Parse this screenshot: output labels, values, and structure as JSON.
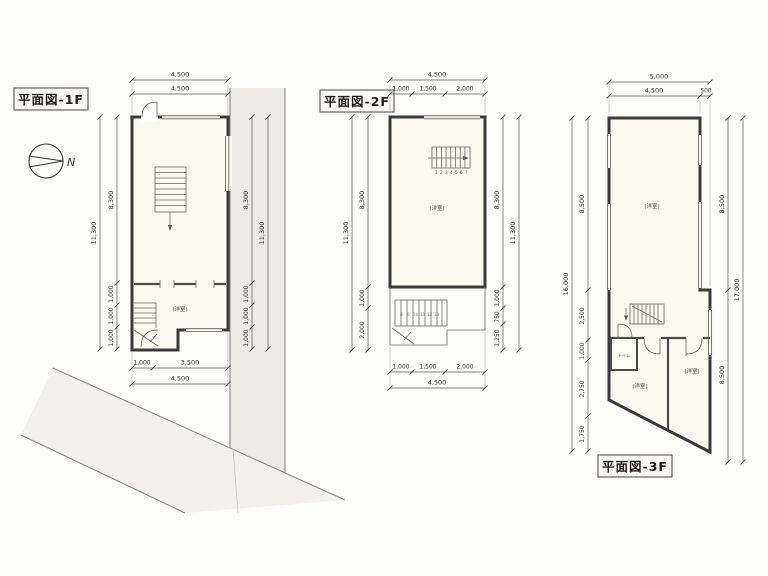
{
  "titles": {
    "f1": "平面図-1F",
    "f2": "平面図-2F",
    "f3": "平面図-3F"
  },
  "compass": {
    "north_label": "N"
  },
  "plan_1f": {
    "room_label": "(洋室)",
    "dims": {
      "top": [
        "4,500",
        "4,500"
      ],
      "left_overall": "11,300",
      "left_segments": [
        "8,300",
        "1,000",
        "1,000",
        "1,000"
      ],
      "right_overall": "11,300",
      "right_segments": [
        "8,300",
        "1,000",
        "1,000",
        "1,000"
      ],
      "bottom_segments": [
        "1,000",
        "3,500"
      ],
      "bottom_overall": "4,500"
    }
  },
  "plan_2f": {
    "room_label": "(洋室)",
    "stair_numbers": [
      "1",
      "2",
      "3",
      "4",
      "5",
      "6",
      "7"
    ],
    "outdoor_stair_numbers": [
      "8",
      "9",
      "10",
      "11",
      "12",
      "13"
    ],
    "dims": {
      "top_overall": "4,500",
      "top_segments": [
        "1,000",
        "1,500",
        "2,000"
      ],
      "left_overall": "11,300",
      "left_segments": [
        "8,300",
        "1,000",
        "2,000"
      ],
      "right_overall": "11,300",
      "right_segments": [
        "8,300",
        "1,000",
        "750",
        "1,250"
      ],
      "bottom_segments": [
        "1,000",
        "1,500",
        "2,000"
      ],
      "bottom_overall": "4,500"
    }
  },
  "plan_3f": {
    "room_label_upper": "(洋室)",
    "room_label_lower_left": "(洋室)",
    "room_label_lower_right": "(洋室)",
    "toilet_label": "トイレ",
    "dims": {
      "top_overall": "5,000",
      "top_segments": [
        "4,500",
        "500"
      ],
      "left_overall": "16,000",
      "left_segments": [
        "8,500",
        "2,500",
        "1,000",
        "2,750",
        "1,750"
      ],
      "right_overall": "17,000",
      "right_segments": [
        "8,500",
        "8,500"
      ]
    }
  }
}
